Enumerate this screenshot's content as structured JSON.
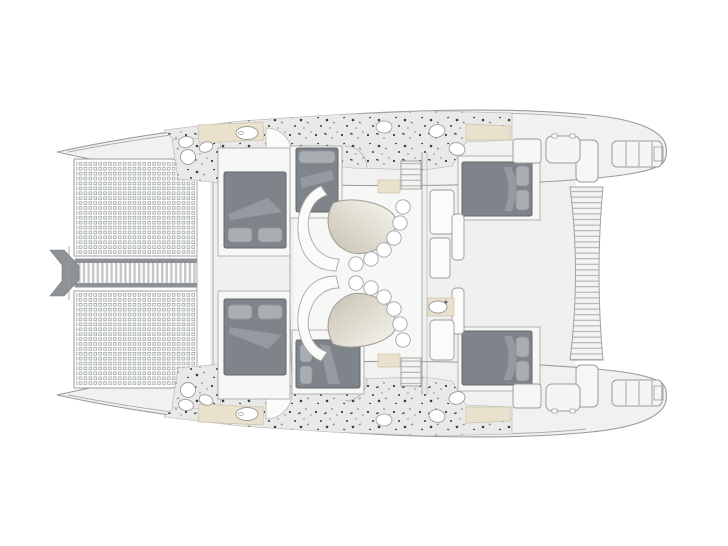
{
  "meta": {
    "type": "yacht-floor-plan",
    "subject": "catamaran deck plan, overhead view",
    "bow_direction": "left",
    "stern_direction": "right"
  },
  "colors": {
    "background": "#ffffff",
    "outline": "#9b9b99",
    "outline_dark": "#7e8286",
    "hull_fill": "#f1f1ef",
    "deck_fill": "#f0f0ee",
    "room_fill": "#f7f7f5",
    "furniture_fill": "#fbfbfa",
    "bed": "#7f848a",
    "bed_border": "#63686d",
    "pillow": "#a9aeb2",
    "blanket": "#989da3",
    "terrazzo_base": "#e9e9e7",
    "speck_dark": "#3c3c3c",
    "speck_mid": "#8b8b89",
    "counter_beige": "#e9e1cb",
    "counter_border": "#c9c2ae",
    "table_grad_start": "#c7c2b1",
    "table_grad_end": "#f7f5ee",
    "walkway_band": "#8e9296",
    "walkway_slat": "#c5c7c8",
    "tramp_grid": "#9fa5a8",
    "slat_line": "#ababa9"
  },
  "features": {
    "trampolines": {
      "count": 2,
      "position": "bow",
      "mesh": "square-grid"
    },
    "bow_walkway": {
      "style": "slatted",
      "position": "between trampolines"
    },
    "bowsprit": {
      "style": "dark chevron",
      "position": "bow tip"
    },
    "cabins": [
      {
        "id": "forward-port",
        "berth": "double",
        "pillows": 2
      },
      {
        "id": "mid-port",
        "berth": "double",
        "pillows": 1
      },
      {
        "id": "aft-port",
        "berth": "double",
        "pillows": 2
      },
      {
        "id": "forward-starboard",
        "berth": "double",
        "pillows": 2
      },
      {
        "id": "mid-starboard",
        "berth": "double",
        "pillows": 2
      },
      {
        "id": "aft-starboard",
        "berth": "double",
        "pillows": 2
      }
    ],
    "dinettes": {
      "count": 2,
      "stools_each": 6,
      "table_shape": "kidney",
      "settee": "curved"
    },
    "galley": {
      "position": "centerline",
      "sink": true
    },
    "bathrooms": {
      "count": 4,
      "floor": "terrazzo speckle",
      "fixtures": "sinks, toilets, beige counters"
    },
    "companionway_stairs": {
      "count": 2,
      "steps": 5
    },
    "cockpit": {
      "lockers": 2,
      "benches": 2
    },
    "stern": {
      "platforms": 2,
      "platform_segments": 4,
      "aft_bench": "slatted curved"
    }
  }
}
